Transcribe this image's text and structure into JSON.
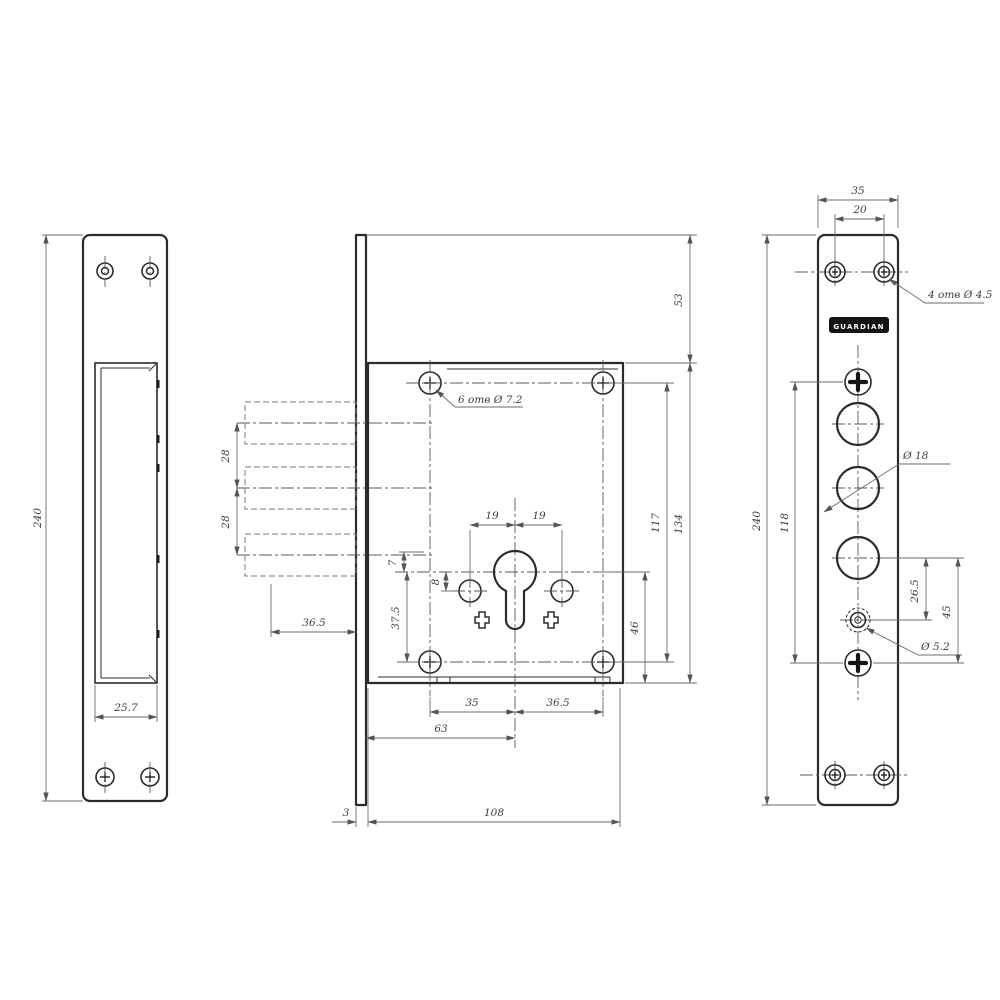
{
  "drawing": {
    "strike_plate": {
      "height": "240",
      "cutout_width": "25.7"
    },
    "body": {
      "holes_note": "6 отв Ø 7.2",
      "top_offset": "53",
      "height": "134",
      "hole_span": "117",
      "keyhole_to_bottom": "46",
      "bolt_pitch_1": "28",
      "bolt_pitch_2": "28",
      "bolt_throw": "36.5",
      "pin_left": "19",
      "pin_right": "19",
      "pin_drop": "8",
      "lip": "7",
      "keyhole_to_hole": "37.5",
      "span_left": "35",
      "span_right": "36.5",
      "backset": "63",
      "width": "108",
      "plate_thickness": "3"
    },
    "faceplate": {
      "width": "35",
      "screw_pitch": "20",
      "screws_note": "4 отв Ø 4.5",
      "brand": "GUARDIAN",
      "bolt_dia": "Ø 18",
      "aux_dia": "Ø 5.2",
      "aux_offset": "26.5",
      "screw_offset": "45",
      "screw_span": "118",
      "height": "240"
    }
  }
}
